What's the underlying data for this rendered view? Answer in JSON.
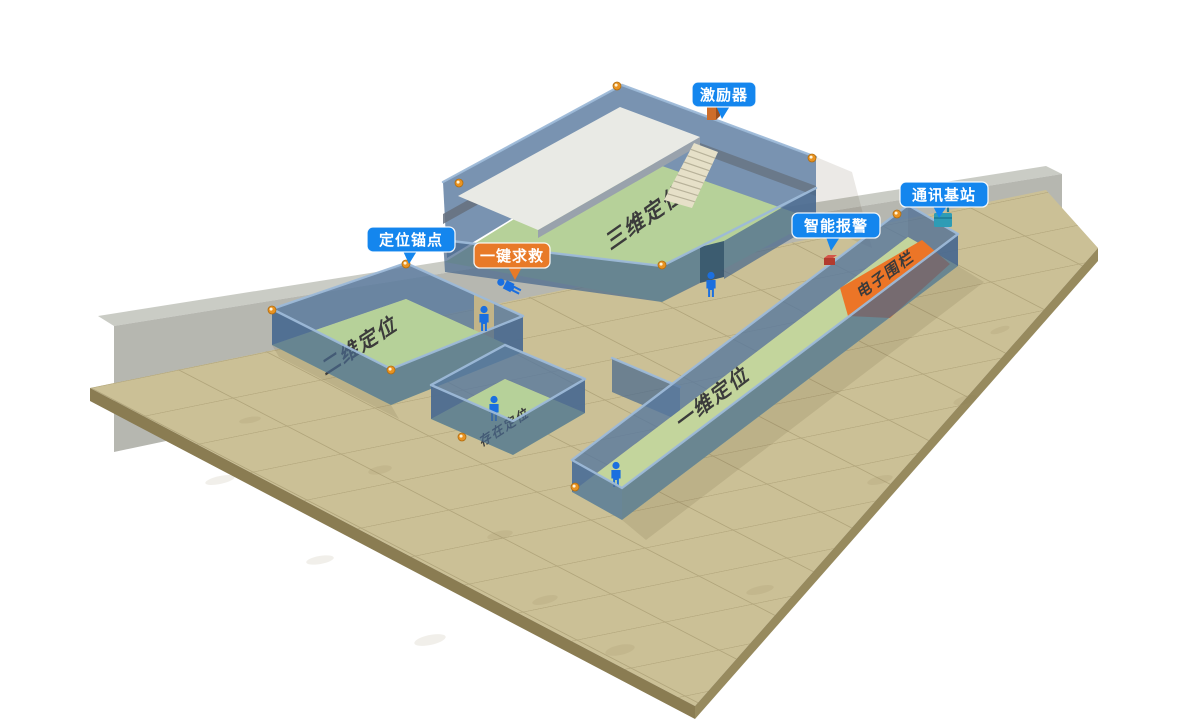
{
  "badges": {
    "exciter": "激励器",
    "comm_station": "通讯基站",
    "smart_alarm": "智能报警",
    "anchor_point": "定位锚点",
    "sos": "一键求救"
  },
  "floor_labels": {
    "room_3d": "三维定位",
    "room_2d": "二维定位",
    "room_presence": "存在定位",
    "corridor_1d": "一维定位",
    "fence": "电子围栏"
  },
  "colors": {
    "badge_blue": "#1486ee",
    "badge_orange": "#e87a28",
    "fence_orange": "#ec7527",
    "room_floor_green": "#b6d199",
    "corridor_floor_green": "#c3d59c",
    "upper_floor_white": "#e9eae5",
    "stairs_cream": "#e6e0c8",
    "platform_tan": "#cbc096",
    "platform_side_brown": "#8a7c52",
    "back_wall_gray": "#a9aaa2",
    "person_blue": "#1b6fdf",
    "anchor_orange": "#e99321",
    "device_exciter_orange": "#cd6d2a",
    "device_alarm_red": "#b23b2e",
    "device_station_teal": "#2e9cb5"
  }
}
